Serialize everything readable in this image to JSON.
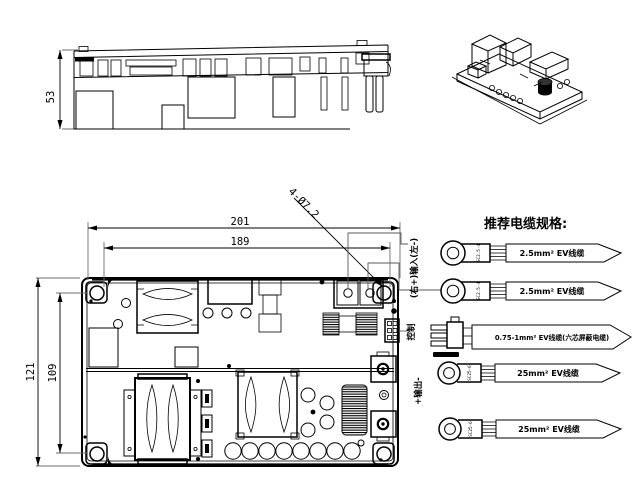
{
  "views": {
    "side_view": {
      "height_dim": "53"
    },
    "top_view": {
      "width_dim_outer": "201",
      "width_dim_inner": "189",
      "height_dim_outer": "121",
      "height_dim_inner": "109",
      "mounting_holes_note": "4-Ø7.2"
    }
  },
  "cable_recommendation": {
    "title": "推荐电缆规格:",
    "input_terminal_label": "(右+)输入(左-)",
    "control_terminal_label": "控制",
    "output_terminal_label": "+输出-",
    "cables": [
      {
        "lug_label": "SC2.5-4",
        "spec": "2.5mm² EV线缆"
      },
      {
        "lug_label": "SC2.5-4",
        "spec": "2.5mm² EV线缆"
      },
      {
        "lug_label": "",
        "spec": "0.75-1mm² EV线缆(六芯屏蔽电缆)"
      },
      {
        "lug_label": "SC25-6",
        "spec": "25mm² EV线缆"
      },
      {
        "lug_label": "SC25-6",
        "spec": "25mm² EV线缆"
      }
    ]
  },
  "colors": {
    "line": "#000000",
    "extension_line": "#6e6e6e",
    "background": "#ffffff"
  }
}
